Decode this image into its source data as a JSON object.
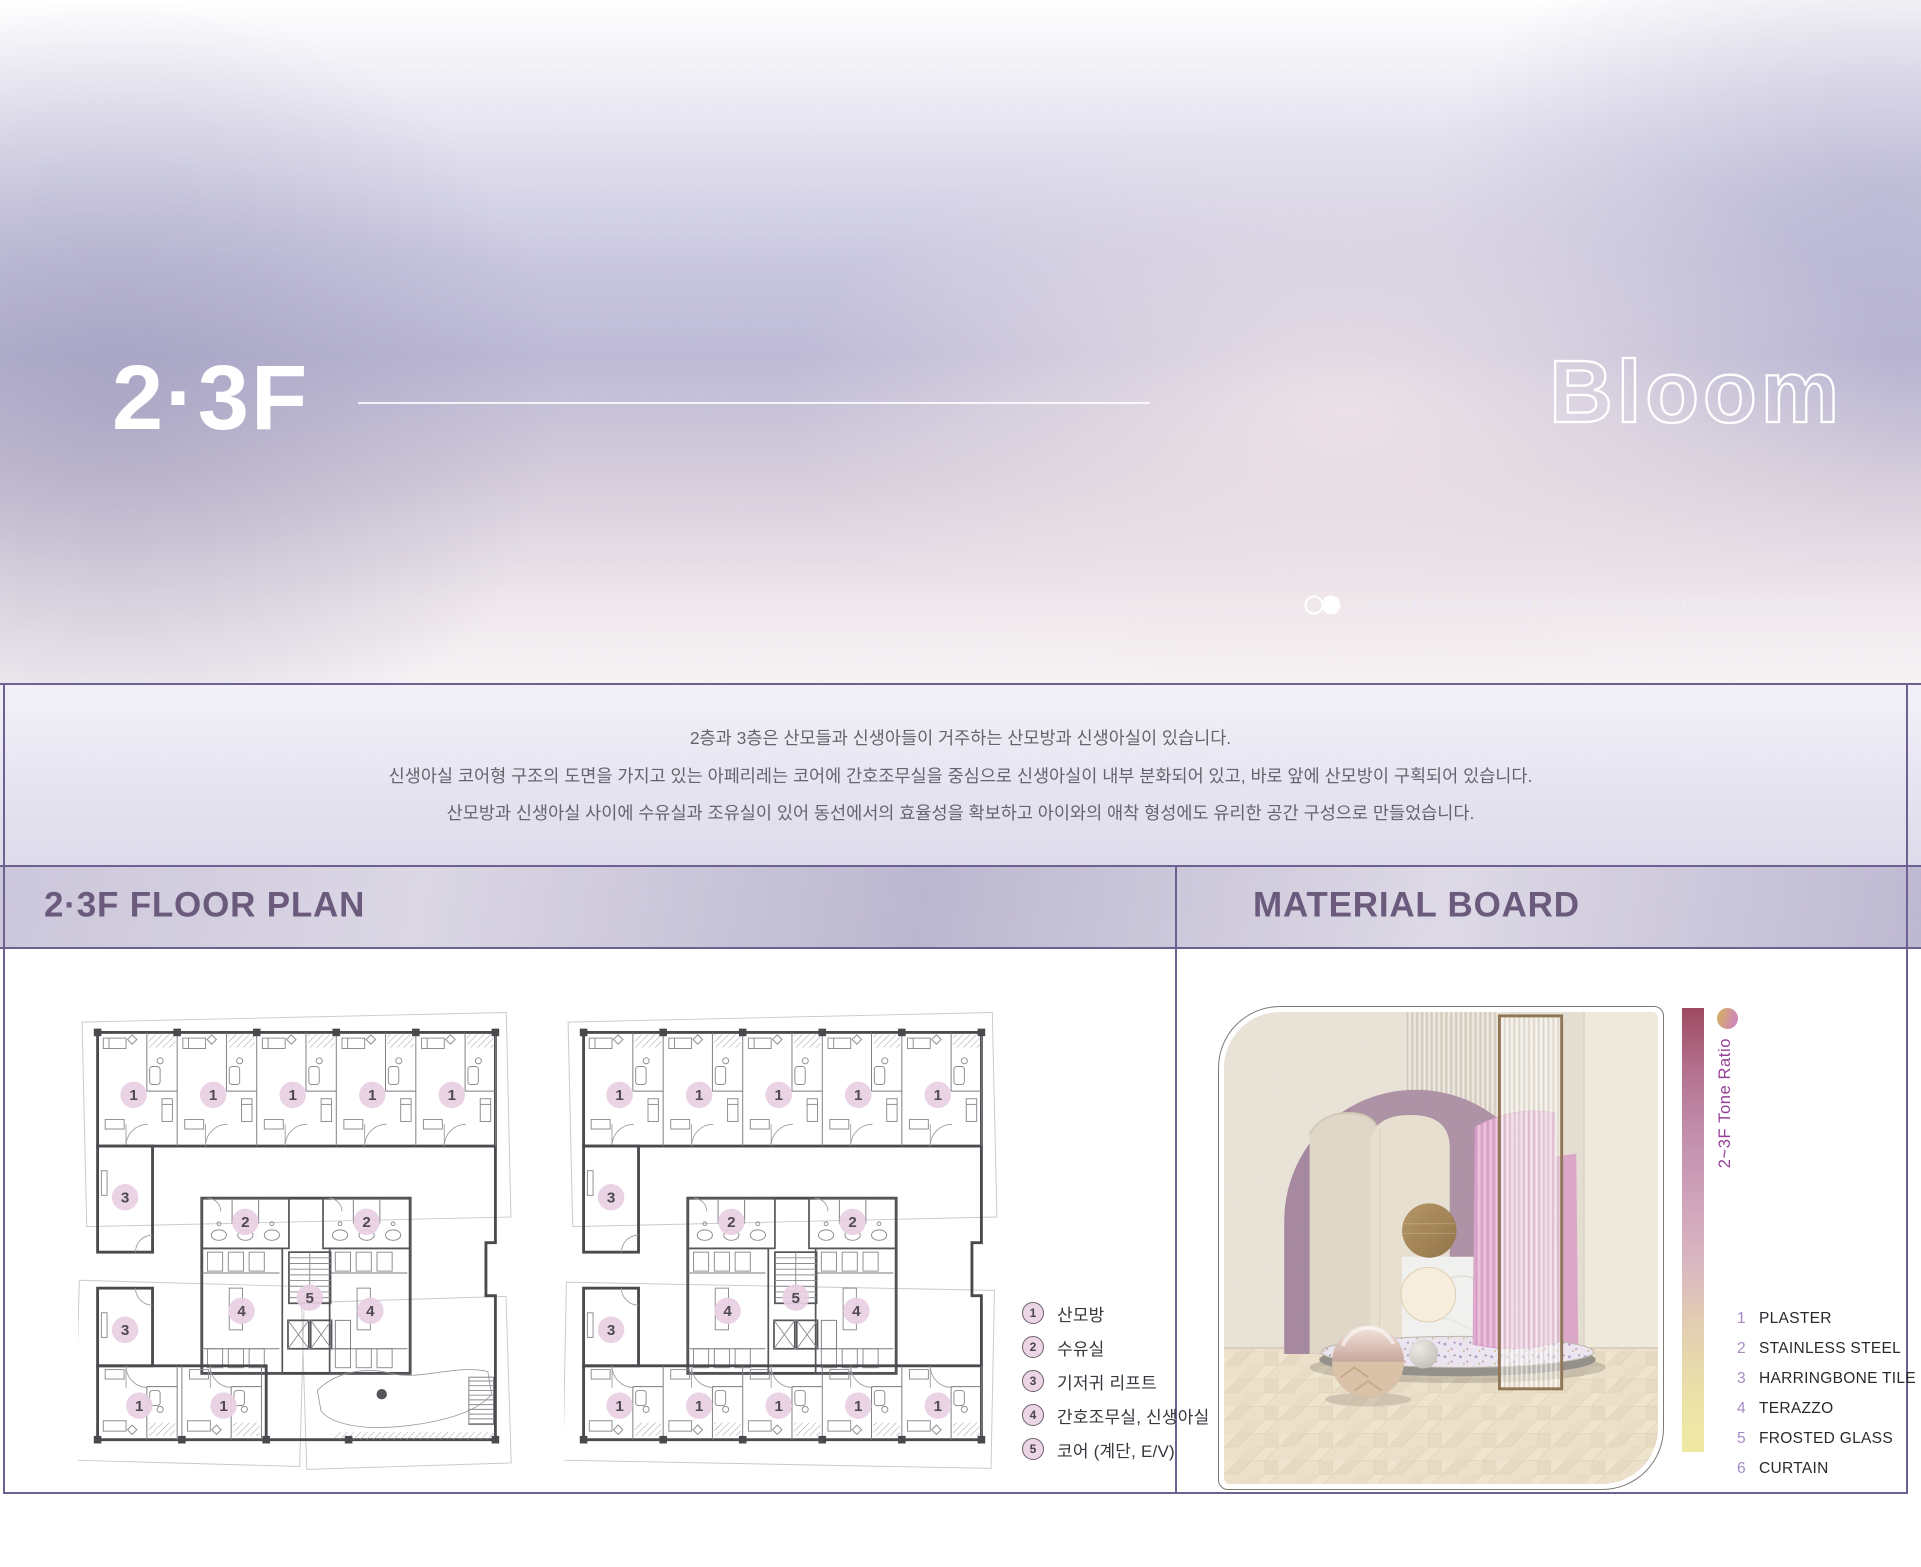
{
  "header": {
    "floor_label": "2·3F",
    "brand": "Bloom",
    "tagline": "FOR COMFORTABLE STAY TO MOTHERS AND BABIES"
  },
  "intro": {
    "lines": [
      "2층과 3층은 산모들과 신생아들이 거주하는 산모방과 신생아실이 있습니다.",
      "신생아실 코어형 구조의 도면을 가지고 있는 아페리레는 코어에 간호조무실을 중심으로 신생아실이 내부 분화되어 있고, 바로 앞에 산모방이 구획되어 있습니다.",
      "산모방과 신생아실 사이에 수유실과 조유실이 있어 동선에서의 효율성을 확보하고 아이와의 애착 형성에도 유리한 공간 구성으로 만들었습니다."
    ]
  },
  "sections": {
    "floor_plan_title": "2·3F FLOOR PLAN",
    "material_board_title": "MATERIAL BOARD"
  },
  "legend": {
    "items": [
      {
        "num": "1",
        "label": "산모방"
      },
      {
        "num": "2",
        "label": "수유실"
      },
      {
        "num": "3",
        "label": "기저귀 리프트"
      },
      {
        "num": "4",
        "label": "간호조무실, 신생아실"
      },
      {
        "num": "5",
        "label": "코어 (계단, E/V)"
      }
    ]
  },
  "materials": {
    "items": [
      {
        "num": "1",
        "label": "PLASTER"
      },
      {
        "num": "2",
        "label": "STAINLESS STEEL"
      },
      {
        "num": "3",
        "label": "HARRINGBONE TILE"
      },
      {
        "num": "4",
        "label": "TERAZZO"
      },
      {
        "num": "5",
        "label": "FROSTED GLASS"
      },
      {
        "num": "6",
        "label": "CURTAIN"
      }
    ]
  },
  "tone_scale": {
    "label": "2~3F Tone Ratio",
    "gradient": [
      "#9e4a60",
      "#b4718e",
      "#c28fad",
      "#cfa3ba",
      "#d9b6c1",
      "#e2cdb2",
      "#eae0a8",
      "#efe9a2"
    ]
  },
  "plans": [
    {
      "id": "plan-2f",
      "variant": "atrium",
      "badges": [
        {
          "n": "1",
          "x": 58,
          "y": 96
        },
        {
          "n": "1",
          "x": 142,
          "y": 96
        },
        {
          "n": "1",
          "x": 226,
          "y": 96
        },
        {
          "n": "1",
          "x": 310,
          "y": 96
        },
        {
          "n": "1",
          "x": 394,
          "y": 96
        },
        {
          "n": "3",
          "x": 49,
          "y": 204
        },
        {
          "n": "2",
          "x": 176,
          "y": 230
        },
        {
          "n": "2",
          "x": 304,
          "y": 230
        },
        {
          "n": "4",
          "x": 172,
          "y": 324
        },
        {
          "n": "4",
          "x": 308,
          "y": 324
        },
        {
          "n": "5",
          "x": 244,
          "y": 310
        },
        {
          "n": "3",
          "x": 49,
          "y": 344
        },
        {
          "n": "1",
          "x": 64,
          "y": 424
        },
        {
          "n": "1",
          "x": 153,
          "y": 424
        }
      ]
    },
    {
      "id": "plan-3f",
      "variant": "rooms",
      "badges": [
        {
          "n": "1",
          "x": 58,
          "y": 96
        },
        {
          "n": "1",
          "x": 142,
          "y": 96
        },
        {
          "n": "1",
          "x": 226,
          "y": 96
        },
        {
          "n": "1",
          "x": 310,
          "y": 96
        },
        {
          "n": "1",
          "x": 394,
          "y": 96
        },
        {
          "n": "3",
          "x": 49,
          "y": 204
        },
        {
          "n": "2",
          "x": 176,
          "y": 230
        },
        {
          "n": "2",
          "x": 304,
          "y": 230
        },
        {
          "n": "4",
          "x": 172,
          "y": 324
        },
        {
          "n": "4",
          "x": 308,
          "y": 324
        },
        {
          "n": "5",
          "x": 244,
          "y": 310
        },
        {
          "n": "3",
          "x": 49,
          "y": 344
        },
        {
          "n": "1",
          "x": 58,
          "y": 424
        },
        {
          "n": "1",
          "x": 142,
          "y": 424
        },
        {
          "n": "1",
          "x": 226,
          "y": 424
        },
        {
          "n": "1",
          "x": 310,
          "y": 424
        },
        {
          "n": "1",
          "x": 394,
          "y": 424
        }
      ]
    }
  ],
  "colors": {
    "heading": "#6a5a7c",
    "frame_line": "#6c6191",
    "badge_fill": "#e8cfe2",
    "tone_label": "#943e95",
    "material_num": "#a58bc2"
  }
}
